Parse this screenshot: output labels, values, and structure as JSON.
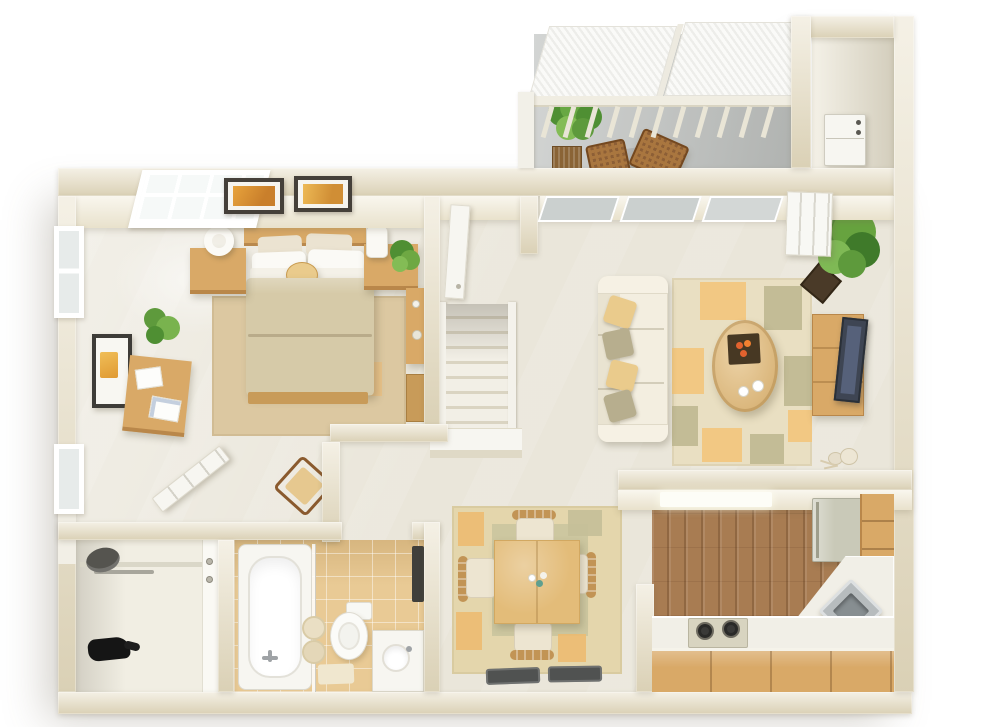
{
  "meta": {
    "title": "3D isometric floor plan render of a one-bedroom apartment",
    "style": "dollhouse cutaway top view, photorealistic render on white background",
    "background": "#FFFFFF"
  },
  "palette": {
    "wall": "#EAE2CC",
    "wall_face": "#F2ECDA",
    "floor_main": "#EAE6DA",
    "floor_balcony": "#C0C3C1",
    "floor_kitchen_wood": "#A87C52",
    "floor_bath_tile": "#E9CA95",
    "floor_closet": "#F1EEE3",
    "floor_utility": "#EDE8D8",
    "rug_bedroom": "#DCC8A1",
    "rug_living": "#E9DFC2",
    "rug_dining_outer": "#E4D6AC",
    "rug_dining_inner": "#CBC59E",
    "accent_orange": "#F2C57E",
    "accent_sage": "#BFB893",
    "sofa_cream": "#F3EEE0",
    "pillow_gold": "#EACB8C",
    "pillow_sage": "#B7AE8E",
    "bed_comforter": "#D6CAA8",
    "bed_pillow_white": "#FBFAF6",
    "wood_light": "#D9A967",
    "wood_mid": "#C89B59",
    "coffee_table": "#E3BC79",
    "tv_dark": "#3E4553",
    "counter_white": "#F1EFE7",
    "fridge_sage": "#C9C9B8",
    "sink_steel": "#B7BCBE",
    "stove_beige": "#D8D4C0",
    "plant_green": "#5E9A3C",
    "planter_dark": "#4A3A28",
    "wicker_brown": "#8D5F36",
    "door_mat": "#505251",
    "fixture_white": "#F7F6F1",
    "glass_gray": "#CBD0CF",
    "screen_white": "#FAFAF8"
  },
  "rooms": [
    {
      "name": "Bedroom",
      "position": "top-left",
      "furniture": [
        "double bed with khaki comforter and white pillows",
        "gold round accent pillow",
        "wood headboard",
        "foot bench",
        "tan area rug",
        "left nightstand with ring lamp",
        "right nightstand with cylinder lamp and potted plant",
        "two framed orange art pictures above bed",
        "gridded skylight window",
        "two wall windows",
        "writing desk with papers",
        "framed wall art",
        "corner potted plant",
        "open white door",
        "corner armchair",
        "side vanity desk with stool"
      ]
    },
    {
      "name": "Balcony",
      "position": "top-right",
      "furniture": [
        "white privacy screen panels",
        "white railing with posts",
        "potted green plant in wicker planter",
        "wicker lattice coffee table",
        "wicker chair"
      ]
    },
    {
      "name": "Utility closet",
      "position": "top-far-right",
      "furniture": [
        "white stacked washer-dryer appliance"
      ]
    },
    {
      "name": "Living room",
      "position": "center-right",
      "furniture": [
        "cream three-seat sofa with gold and sage pillows",
        "patchwork rug with orange and sage blocks",
        "oval wood coffee table",
        "dark tray with orange flowers",
        "two white cups",
        "wood TV console",
        "dark flat-screen TV",
        "large corner potted plant",
        "beige plush toy on floor",
        "sliding glass doors to balcony",
        "white sliding door panel"
      ]
    },
    {
      "name": "Hallway and stairs",
      "position": "center",
      "furniture": [
        "white staircase with side rails",
        "white landing platform",
        "white door at top of stairs"
      ]
    },
    {
      "name": "Dining area",
      "position": "bottom-center",
      "furniture": [
        "square light-wood dining table",
        "flower centerpiece",
        "four cream upholstered chairs with wood backs",
        "sage and tan area rug with orange patches",
        "two dark entry mats"
      ]
    },
    {
      "name": "Kitchen",
      "position": "bottom-right",
      "furniture": [
        "vertical wood plank floor",
        "recessed ceiling light",
        "sage-white refrigerator",
        "wood drawer cabinets along right wall",
        "white corner counter",
        "diagonal stainless corner sink",
        "two-burner cooktop",
        "wood cabinet front under counter"
      ]
    },
    {
      "name": "Bathroom",
      "position": "bottom-left-center",
      "furniture": [
        "white bathtub with chrome faucet",
        "glass divider",
        "toilet",
        "white vanity with round sink",
        "rolled towels",
        "beige bath mat",
        "dark wall shelf",
        "tan tile floor"
      ]
    },
    {
      "name": "Closet",
      "position": "bottom-left",
      "furniture": [
        "shelf and clothes rod",
        "gray hat",
        "black bag on floor",
        "white door edge with two knobs"
      ]
    }
  ]
}
